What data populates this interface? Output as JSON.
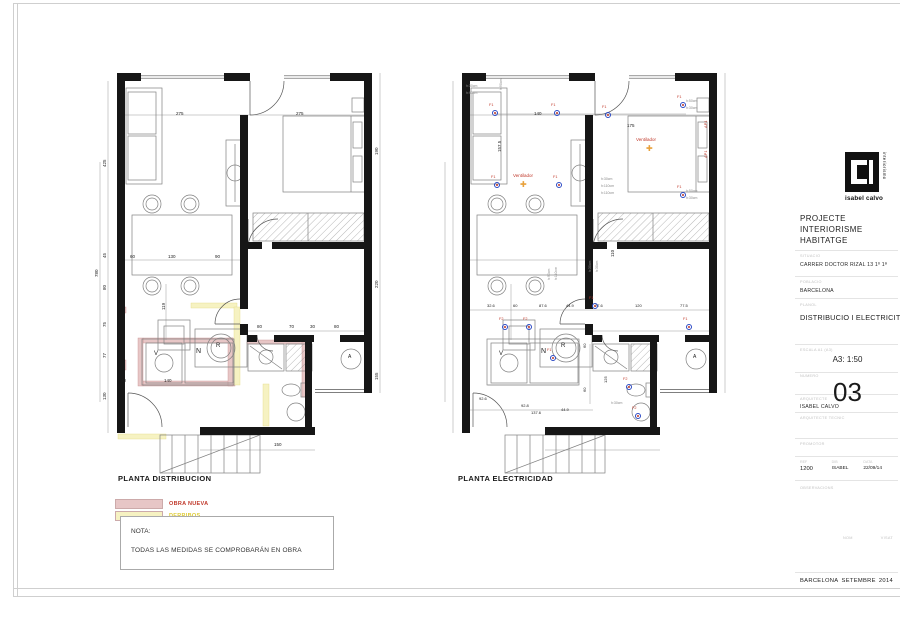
{
  "titleblock": {
    "logo": {
      "name": "isabel calvo",
      "vertical": "interiorismo"
    },
    "project_title": "PROJECTE INTERIORISME HABITATGE",
    "situacio_label": "SITUACIO",
    "situacio": "CARRER DOCTOR RIZAL 13 1º 1ª",
    "poblacio_label": "POBLACIO",
    "poblacio": "BARCELONA",
    "planol_label": "PLANOL",
    "planol": "DISTRIBUCIO I ELECTRICITAT",
    "escala_label": "ESCALA A1 (A3)",
    "escala": "A3: 1:50",
    "numero_label": "NUMERO",
    "numero": "03",
    "arquitecte_label": "ARQUITECTE",
    "arquitecte": "ISABEL CALVO",
    "arq_tecnic_label": "ARQUITECTE TECNIC",
    "promotor_label": "PROMOTOR",
    "ref_label": "REF",
    "ref": "1200",
    "dib_label": "DIB",
    "dib": "ISABEL",
    "data_label": "DATA",
    "data": "22/09/14",
    "observacions_label": "OBSERVACIONS",
    "nom_label": "NOM",
    "visat_label": "VISAT",
    "footer_city": "BARCELONA",
    "footer_month": "SETEMBRE",
    "footer_year": "2014"
  },
  "legend": {
    "items": [
      {
        "label": "OBRA NUEVA",
        "color": "#e7c6c6",
        "text_color": "#c0392b"
      },
      {
        "label": "DERRIBOS",
        "color": "#f6f2c2",
        "text_color": "#ddca33"
      }
    ]
  },
  "note": {
    "title": "NOTA:",
    "body": "TODAS LAS MEDIDAS SE COMPROBARÁN EN OBRA"
  },
  "plans": {
    "left": {
      "title": "PLANTA DISTRIBUCION",
      "labels": [
        {
          "x": 118,
          "y": 60,
          "t": "275"
        },
        {
          "x": 238,
          "y": 60,
          "t": "275"
        },
        {
          "x": 45,
          "y": 115,
          "t": "425",
          "r": -90
        },
        {
          "x": 37,
          "y": 225,
          "t": "780",
          "r": -90
        },
        {
          "x": 45,
          "y": 206,
          "t": "45",
          "r": -90
        },
        {
          "x": 45,
          "y": 238,
          "t": "80",
          "r": -90
        },
        {
          "x": 45,
          "y": 275,
          "t": "75",
          "r": -90
        },
        {
          "x": 45,
          "y": 306,
          "t": "77",
          "r": -90
        },
        {
          "x": 45,
          "y": 348,
          "t": "130",
          "r": -90
        },
        {
          "x": 317,
          "y": 103,
          "t": "190",
          "r": -90
        },
        {
          "x": 317,
          "y": 236,
          "t": "220",
          "r": -90
        },
        {
          "x": 317,
          "y": 328,
          "t": "155",
          "r": -90
        },
        {
          "x": 72,
          "y": 203,
          "t": "60"
        },
        {
          "x": 110,
          "y": 203,
          "t": "130"
        },
        {
          "x": 157,
          "y": 203,
          "t": "90"
        },
        {
          "x": 104,
          "y": 258,
          "t": "119",
          "r": -90
        },
        {
          "x": 106,
          "y": 327,
          "t": "140"
        },
        {
          "x": 199,
          "y": 273,
          "t": "80"
        },
        {
          "x": 231,
          "y": 273,
          "t": "70"
        },
        {
          "x": 252,
          "y": 273,
          "t": "30"
        },
        {
          "x": 276,
          "y": 273,
          "t": "80"
        },
        {
          "x": 216,
          "y": 391,
          "t": "150"
        },
        {
          "x": 63,
          "y": 327,
          "t": "40"
        },
        {
          "x": 158,
          "y": 291,
          "t": "R",
          "s": 6
        },
        {
          "x": 96,
          "y": 299,
          "t": "V",
          "s": 6
        },
        {
          "x": 138,
          "y": 296,
          "t": "N",
          "s": 7
        },
        {
          "x": 290,
          "y": 303,
          "t": "A",
          "s": 5
        }
      ]
    },
    "right": {
      "title": "PLANTA ELECTRICIDAD",
      "labels": [
        {
          "x": 131,
          "y": 60,
          "t": "140"
        },
        {
          "x": 224,
          "y": 72,
          "t": "175"
        },
        {
          "x": 95,
          "y": 100,
          "t": "157.5",
          "r": -90
        },
        {
          "x": 183,
          "y": 122,
          "t": "200",
          "r": -90
        },
        {
          "x": 208,
          "y": 205,
          "t": "110",
          "r": -90
        },
        {
          "x": 84,
          "y": 252,
          "t": "32.6",
          "s": 4
        },
        {
          "x": 110,
          "y": 252,
          "t": "60",
          "s": 4
        },
        {
          "x": 136,
          "y": 252,
          "t": "87.6",
          "s": 4
        },
        {
          "x": 163,
          "y": 252,
          "t": "44.9",
          "s": 4
        },
        {
          "x": 192,
          "y": 252,
          "t": "77.6",
          "s": 4
        },
        {
          "x": 232,
          "y": 252,
          "t": "120",
          "s": 4
        },
        {
          "x": 277,
          "y": 252,
          "t": "77.5",
          "s": 4
        },
        {
          "x": 76,
          "y": 345,
          "t": "92.6",
          "s": 4
        },
        {
          "x": 118,
          "y": 352,
          "t": "92.8",
          "s": 4
        },
        {
          "x": 128,
          "y": 359,
          "t": "137.6",
          "s": 4
        },
        {
          "x": 158,
          "y": 356,
          "t": "44.9",
          "s": 4
        },
        {
          "x": 201,
          "y": 331,
          "t": "125",
          "r": -90,
          "s": 4
        },
        {
          "x": 180,
          "y": 296,
          "t": "60",
          "r": -90,
          "s": 4
        },
        {
          "x": 180,
          "y": 340,
          "t": "60",
          "r": -90,
          "s": 4
        },
        {
          "x": 63,
          "y": 33,
          "t": "h:30cm",
          "c": "grey",
          "s": 3.5
        },
        {
          "x": 63,
          "y": 40,
          "t": "h:90cm",
          "c": "grey",
          "s": 3.5
        },
        {
          "x": 97,
          "y": 38,
          "t": "h:90cm",
          "c": "grey",
          "s": 3.5,
          "r": -90
        },
        {
          "x": 145,
          "y": 228,
          "t": "h:90cm",
          "c": "grey",
          "s": 3.5,
          "r": -90
        },
        {
          "x": 152,
          "y": 228,
          "t": "h:110cm",
          "c": "grey",
          "s": 3.5,
          "r": -90
        },
        {
          "x": 198,
          "y": 126,
          "t": "h:30cm",
          "c": "grey",
          "s": 3.5
        },
        {
          "x": 198,
          "y": 133,
          "t": "h:110cm",
          "c": "grey",
          "s": 3.5
        },
        {
          "x": 198,
          "y": 140,
          "t": "h:110cm",
          "c": "grey",
          "s": 3.5
        },
        {
          "x": 283,
          "y": 48,
          "t": "h:50cm",
          "c": "grey",
          "s": 3.5
        },
        {
          "x": 283,
          "y": 55,
          "t": "h:30cm",
          "c": "grey",
          "s": 3.5
        },
        {
          "x": 283,
          "y": 138,
          "t": "h:50cm",
          "c": "grey",
          "s": 3.5
        },
        {
          "x": 283,
          "y": 145,
          "t": "h:30cm",
          "c": "grey",
          "s": 3.5
        },
        {
          "x": 186,
          "y": 220,
          "t": "h:30cm",
          "c": "grey",
          "s": 3.5,
          "r": -90
        },
        {
          "x": 193,
          "y": 220,
          "t": "h:30cm",
          "c": "grey",
          "s": 3.5,
          "r": -90
        },
        {
          "x": 208,
          "y": 350,
          "t": "h:30cm",
          "c": "grey",
          "s": 3.5
        },
        {
          "x": 86,
          "y": 52,
          "t": "F1",
          "c": "red",
          "s": 3.8
        },
        {
          "x": 89,
          "y": 58,
          "type": "socket"
        },
        {
          "x": 148,
          "y": 52,
          "t": "F1",
          "c": "red",
          "s": 3.8
        },
        {
          "x": 151,
          "y": 58,
          "type": "socket"
        },
        {
          "x": 199,
          "y": 54,
          "t": "F1",
          "c": "red",
          "s": 3.8
        },
        {
          "x": 202,
          "y": 60,
          "type": "socket"
        },
        {
          "x": 274,
          "y": 44,
          "t": "F1",
          "c": "red",
          "s": 3.8
        },
        {
          "x": 277,
          "y": 50,
          "type": "socket"
        },
        {
          "x": 88,
          "y": 124,
          "t": "F1",
          "c": "red",
          "s": 3.8
        },
        {
          "x": 91,
          "y": 130,
          "type": "socket"
        },
        {
          "x": 150,
          "y": 124,
          "t": "F1",
          "c": "red",
          "s": 3.8
        },
        {
          "x": 153,
          "y": 130,
          "type": "socket"
        },
        {
          "x": 274,
          "y": 134,
          "t": "F1",
          "c": "red",
          "s": 3.8
        },
        {
          "x": 277,
          "y": 140,
          "type": "socket"
        },
        {
          "x": 96,
          "y": 266,
          "t": "F2",
          "c": "red",
          "s": 3.8
        },
        {
          "x": 99,
          "y": 272,
          "type": "socket"
        },
        {
          "x": 120,
          "y": 266,
          "t": "F2",
          "c": "red",
          "s": 3.8
        },
        {
          "x": 123,
          "y": 272,
          "type": "socket"
        },
        {
          "x": 144,
          "y": 297,
          "t": "F1",
          "c": "red",
          "s": 3.8
        },
        {
          "x": 147,
          "y": 303,
          "type": "socket"
        },
        {
          "x": 186,
          "y": 245,
          "t": "F1",
          "c": "red",
          "s": 3.8
        },
        {
          "x": 189,
          "y": 251,
          "type": "socket"
        },
        {
          "x": 220,
          "y": 326,
          "t": "F2",
          "c": "red",
          "s": 3.8
        },
        {
          "x": 223,
          "y": 332,
          "type": "socket"
        },
        {
          "x": 229,
          "y": 355,
          "t": "F2",
          "c": "red",
          "s": 3.8
        },
        {
          "x": 232,
          "y": 361,
          "type": "socket"
        },
        {
          "x": 280,
          "y": 266,
          "t": "F1",
          "c": "red",
          "s": 3.8
        },
        {
          "x": 283,
          "y": 272,
          "type": "socket"
        },
        {
          "x": 110,
          "y": 122,
          "t": "Ventilador",
          "c": "red",
          "s": 4.5
        },
        {
          "x": 117,
          "y": 129,
          "t": "✚",
          "c": "orange",
          "s": 8,
          "type": "fan"
        },
        {
          "x": 233,
          "y": 86,
          "t": "Ventilador",
          "c": "red",
          "s": 4.5
        },
        {
          "x": 243,
          "y": 93,
          "t": "✚",
          "c": "orange",
          "s": 8,
          "type": "fan"
        },
        {
          "x": 301,
          "y": 76,
          "t": "AP1",
          "c": "red",
          "s": 4,
          "r": -90
        },
        {
          "x": 301,
          "y": 106,
          "t": "AP1",
          "c": "red",
          "s": 4,
          "r": -90
        },
        {
          "x": 158,
          "y": 291,
          "t": "R",
          "s": 6
        },
        {
          "x": 96,
          "y": 299,
          "t": "V",
          "s": 6
        },
        {
          "x": 138,
          "y": 296,
          "t": "N",
          "s": 7
        },
        {
          "x": 290,
          "y": 303,
          "t": "A",
          "s": 5
        }
      ]
    }
  }
}
